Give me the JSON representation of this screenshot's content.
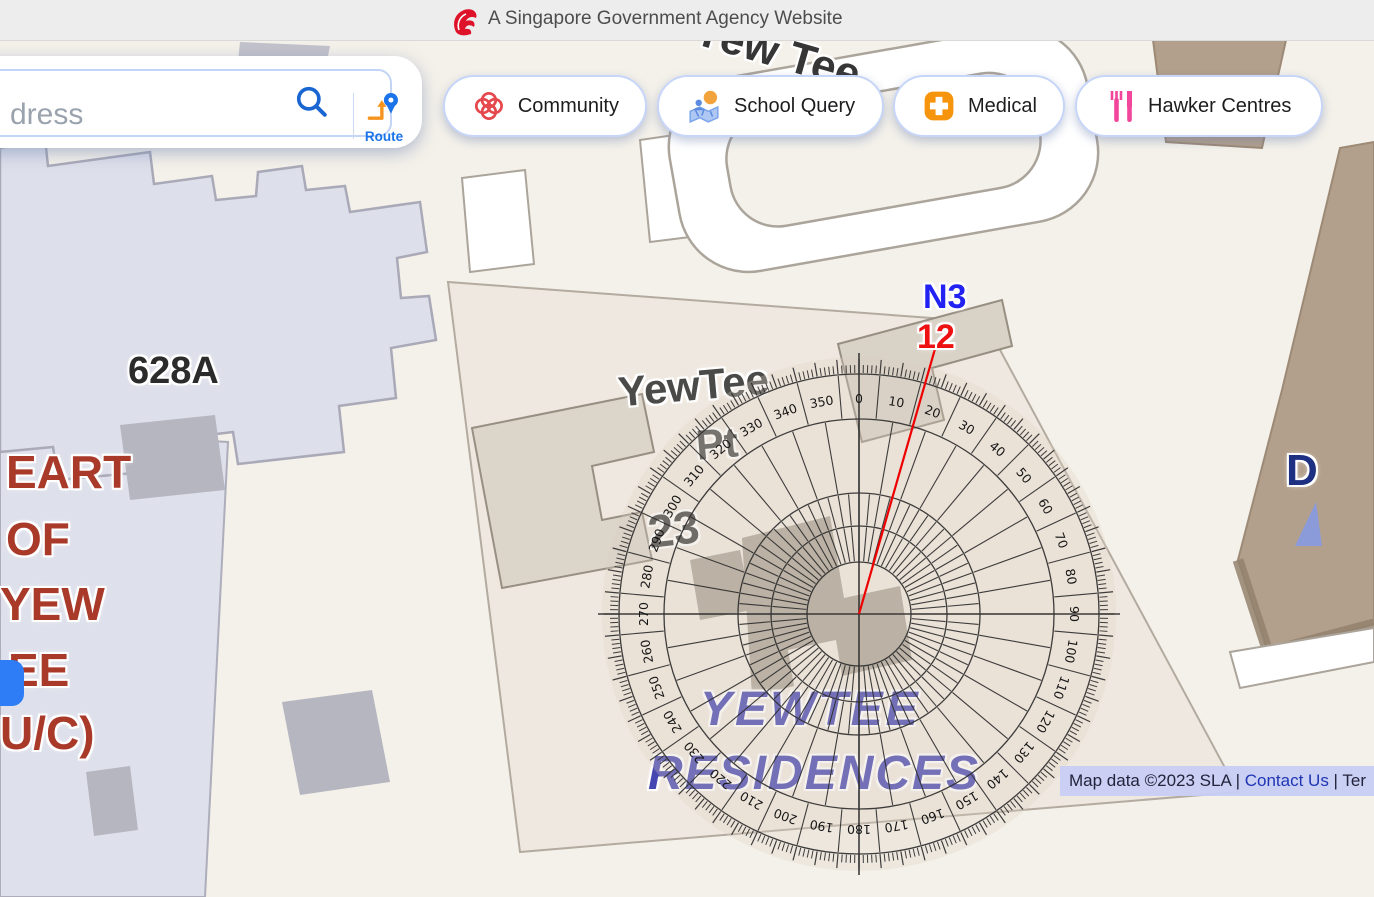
{
  "header": {
    "banner": "A Singapore Government Agency Website"
  },
  "search": {
    "placeholder_visible": "dress",
    "route_label": "Route"
  },
  "nav_buttons": [
    {
      "label": "Community"
    },
    {
      "label": "School Query"
    },
    {
      "label": "Medical"
    },
    {
      "label": "Hawker Centres"
    }
  ],
  "map": {
    "labels": {
      "area_top": "Yew Tee",
      "block_628a": "628A",
      "yewtee_pt_line1": "YewTee",
      "yewtee_pt_line2": "Pt",
      "block_23": "23",
      "residences_line1": "YEWTEE",
      "residences_line2": "RESIDENCES",
      "heart_lines": [
        "EART",
        "OF",
        "YEW",
        "EE",
        "U/C)"
      ],
      "marker_d": "D"
    },
    "attribution": {
      "prefix": "Map data ©2023 SLA | ",
      "contact_link": "Contact Us",
      "suffix": " | Ter"
    }
  },
  "protractor": {
    "degree_labels": [
      "0",
      "10",
      "20",
      "30",
      "40",
      "50",
      "60",
      "70",
      "80",
      "90",
      "100",
      "110",
      "120",
      "130",
      "140",
      "150",
      "160",
      "170",
      "180",
      "190",
      "200",
      "210",
      "220",
      "230",
      "240",
      "250",
      "260",
      "270",
      "280",
      "290",
      "300",
      "310",
      "320",
      "330",
      "340",
      "350"
    ],
    "bearing": {
      "marker_label": "N3",
      "value_label": "12",
      "line_degrees": 16
    },
    "line_color": "#ee0000"
  }
}
